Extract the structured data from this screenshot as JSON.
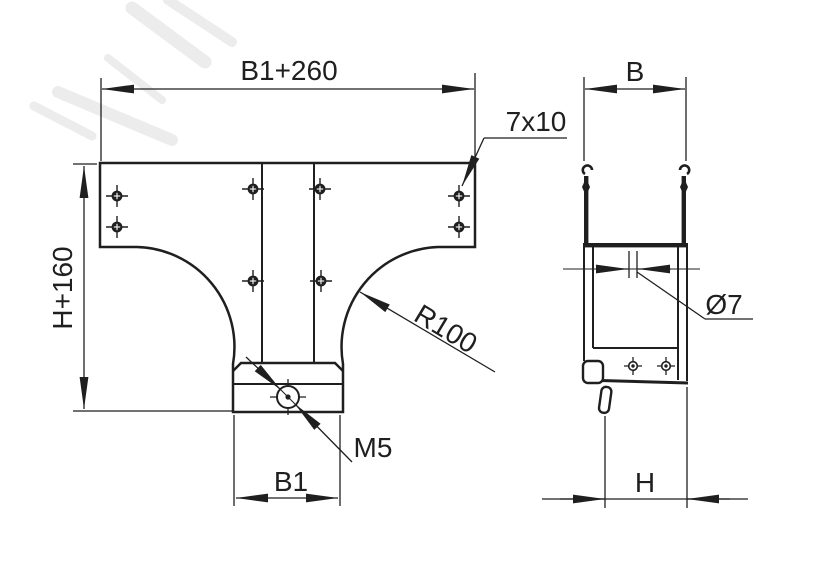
{
  "front_view": {
    "width_dim": "B1+260",
    "height_dim": "H+160",
    "slot_callout": "7x10",
    "radius_callout": "R100",
    "thread_callout": "M5",
    "base_width_dim": "B1"
  },
  "side_view": {
    "width_dim": "B",
    "hole_callout": "Ø7",
    "depth_dim": "H"
  },
  "colors": {
    "line": "#1f1f1f",
    "background": "#ffffff",
    "watermark": "#ececec"
  }
}
